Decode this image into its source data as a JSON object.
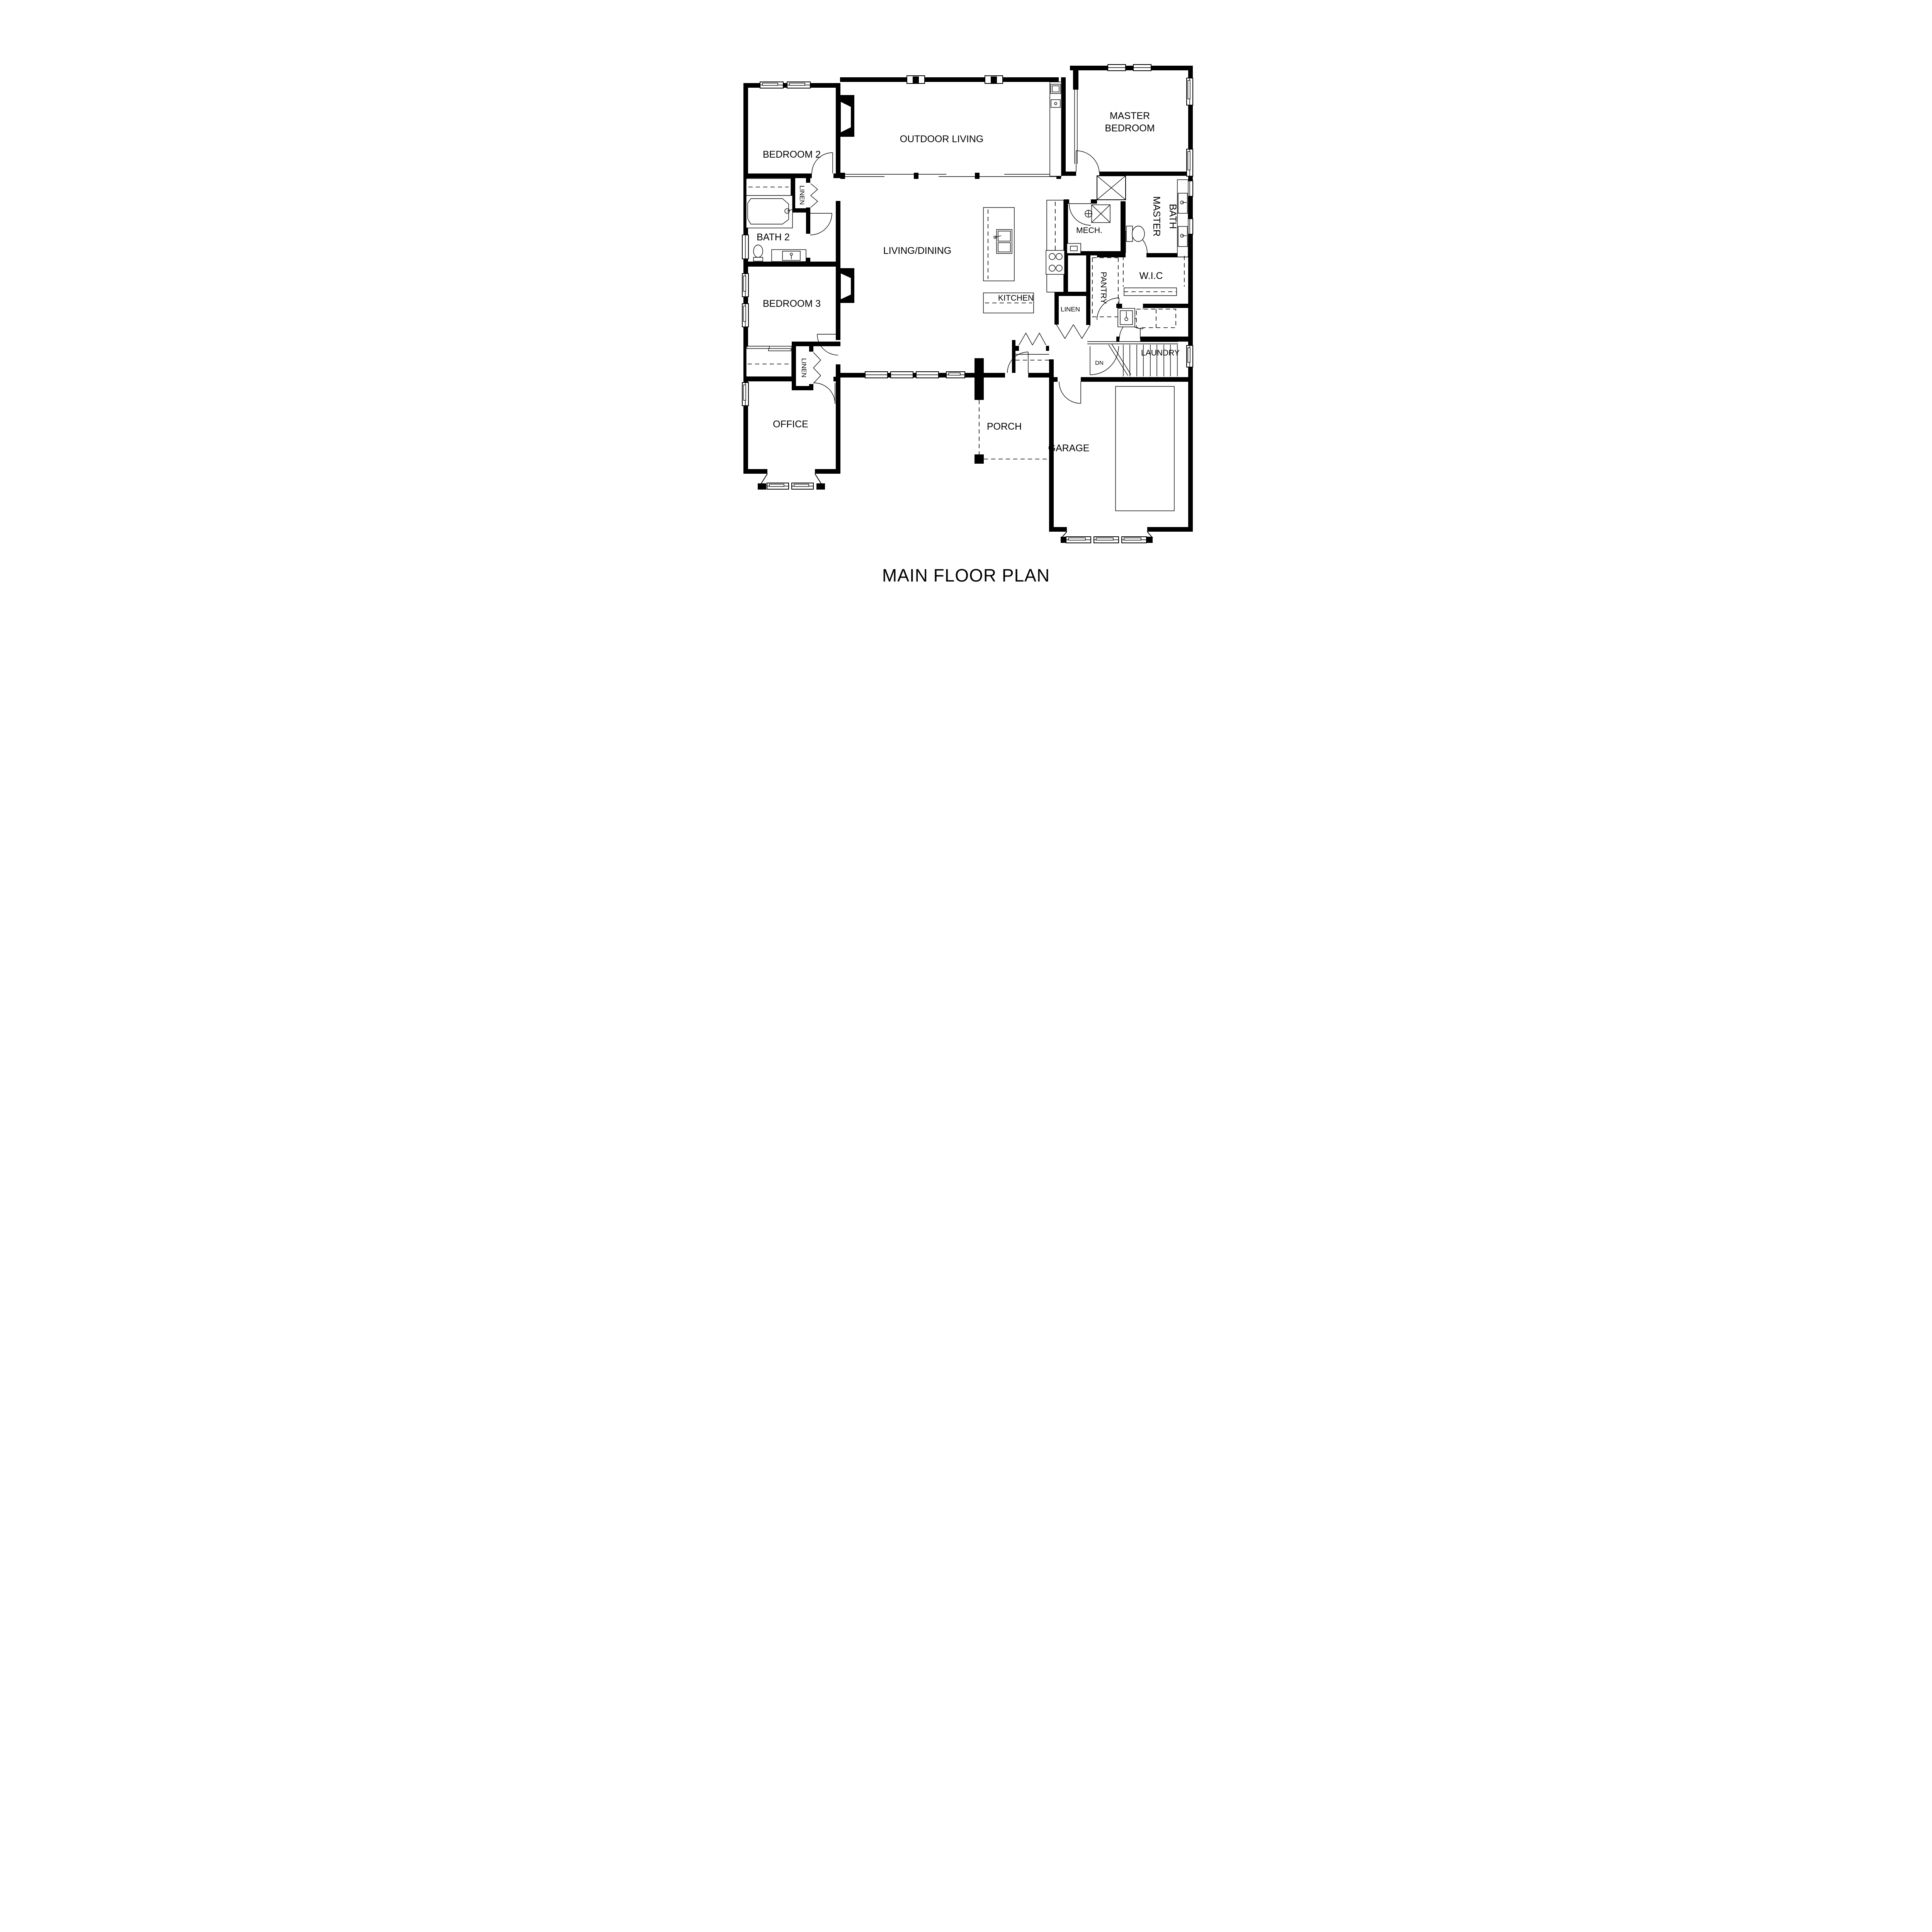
{
  "title": "MAIN FLOOR PLAN",
  "colors": {
    "ink": "#000000",
    "paper": "#ffffff"
  },
  "rooms": {
    "bedroom2": "BEDROOM 2",
    "outdoor_living": "OUTDOOR LIVING",
    "master_bedroom_line1": "MASTER",
    "master_bedroom_line2": "BEDROOM",
    "linen_hall": "LINEN",
    "bath2": "BATH 2",
    "living_dining": "LIVING/DINING",
    "mech": "MECH.",
    "master_bath_line1": "MASTER",
    "master_bath_line2": "BATH",
    "kitchen": "KITCHEN",
    "pantry": "PANTRY",
    "wic": "W.I.C",
    "linen_kitchen": "LINEN",
    "laundry": "LAUNDRY",
    "bedroom3": "BEDROOM 3",
    "linen_bedroom3": "LINEN",
    "office": "OFFICE",
    "porch": "PORCH",
    "garage": "GARAGE",
    "stairs_down": "DN"
  }
}
